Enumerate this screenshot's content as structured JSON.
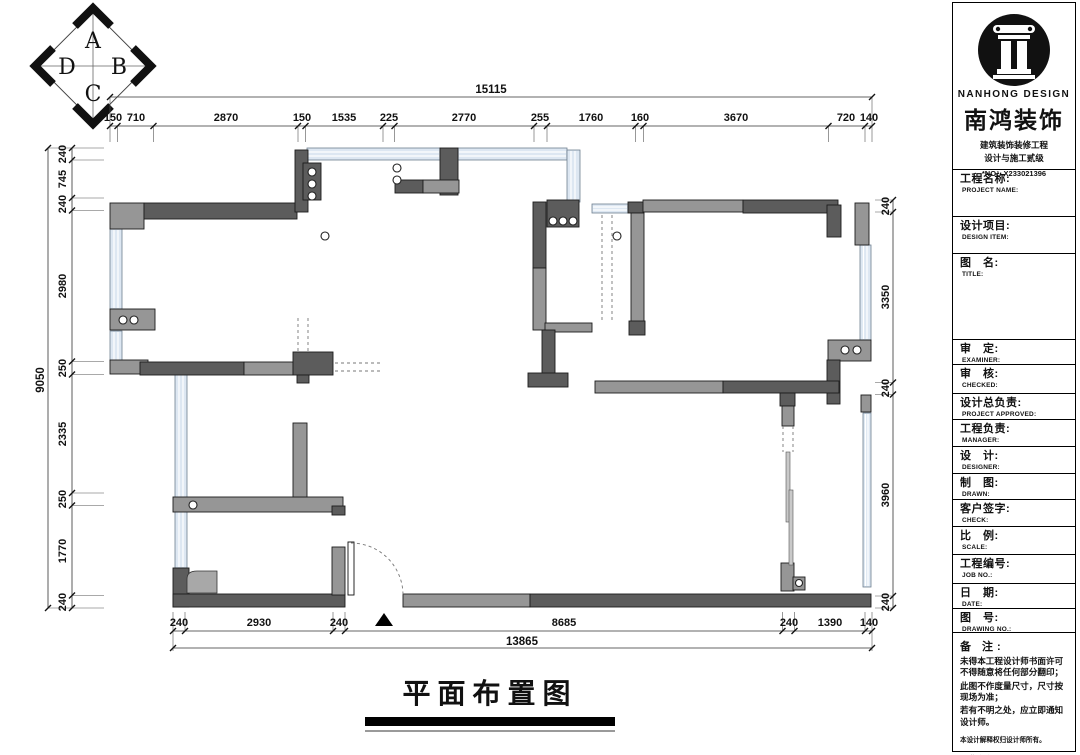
{
  "compass": {
    "top": "A",
    "right": "B",
    "bottom": "C",
    "left": "D"
  },
  "dimensions": {
    "top_total": "15115",
    "top": [
      "150",
      "710",
      "2870",
      "150",
      "1535",
      "225",
      "2770",
      "255",
      "1760",
      "160",
      "3670",
      "720",
      "140"
    ],
    "left_total": "9050",
    "left": [
      "240",
      "745",
      "240",
      "2980",
      "250",
      "2335",
      "250",
      "1770",
      "240"
    ],
    "right": [
      "240",
      "3350",
      "240",
      "3960",
      "240"
    ],
    "bottom": [
      "240",
      "2930",
      "240",
      "8685",
      "240",
      "1390",
      "140"
    ],
    "bottom_total": "13865"
  },
  "drawing_title": "平面布置图",
  "title_block": {
    "brand_en": "NANHONG DESIGN",
    "brand_cn": "南鸿装饰",
    "cert_line1": "建筑装饰装修工程",
    "cert_line2": "设计与施工贰级",
    "cert_no": "*NO：X233021396",
    "fields": [
      {
        "cn": "工程名称:",
        "en": "PROJECT NAME:"
      },
      {
        "cn": "设计项目:",
        "en": "DESIGN ITEM:"
      },
      {
        "cn": "图　名:",
        "en": "TITLE:"
      },
      {
        "cn": "审　定:",
        "en": "EXAMINER:"
      },
      {
        "cn": "审　核:",
        "en": "CHECKED:"
      },
      {
        "cn": "设计总负责:",
        "en": "PROJECT APPROVED:"
      },
      {
        "cn": "工程负责:",
        "en": "MANAGER:"
      },
      {
        "cn": "设　计:",
        "en": "DESIGNER:"
      },
      {
        "cn": "制　图:",
        "en": "DRAWN:"
      },
      {
        "cn": "客户签字:",
        "en": "CHECK:"
      },
      {
        "cn": "比　例:",
        "en": "SCALE:"
      },
      {
        "cn": "工程编号:",
        "en": "JOB NO.:"
      },
      {
        "cn": "日　期:",
        "en": "DATE:"
      },
      {
        "cn": "图　号:",
        "en": "DRAWING NO.:"
      }
    ],
    "notes_title": "备 注:",
    "note1": "未得本工程设计师书面许可不得随意将任何部分翻印；",
    "note2": "此图不作度量尺寸，尺寸按现场为准；",
    "note3": "若有不明之处，应立即通知设计师。",
    "copyright": "本设计解释权归设计师所有。",
    "hotline": "免费咨询电话:400 8383 168"
  },
  "colors": {
    "wall_dark": "#5c5c5c",
    "wall_mid": "#969696",
    "window_fill": "#dde7f2",
    "window_edge": "#6f7f8f"
  }
}
